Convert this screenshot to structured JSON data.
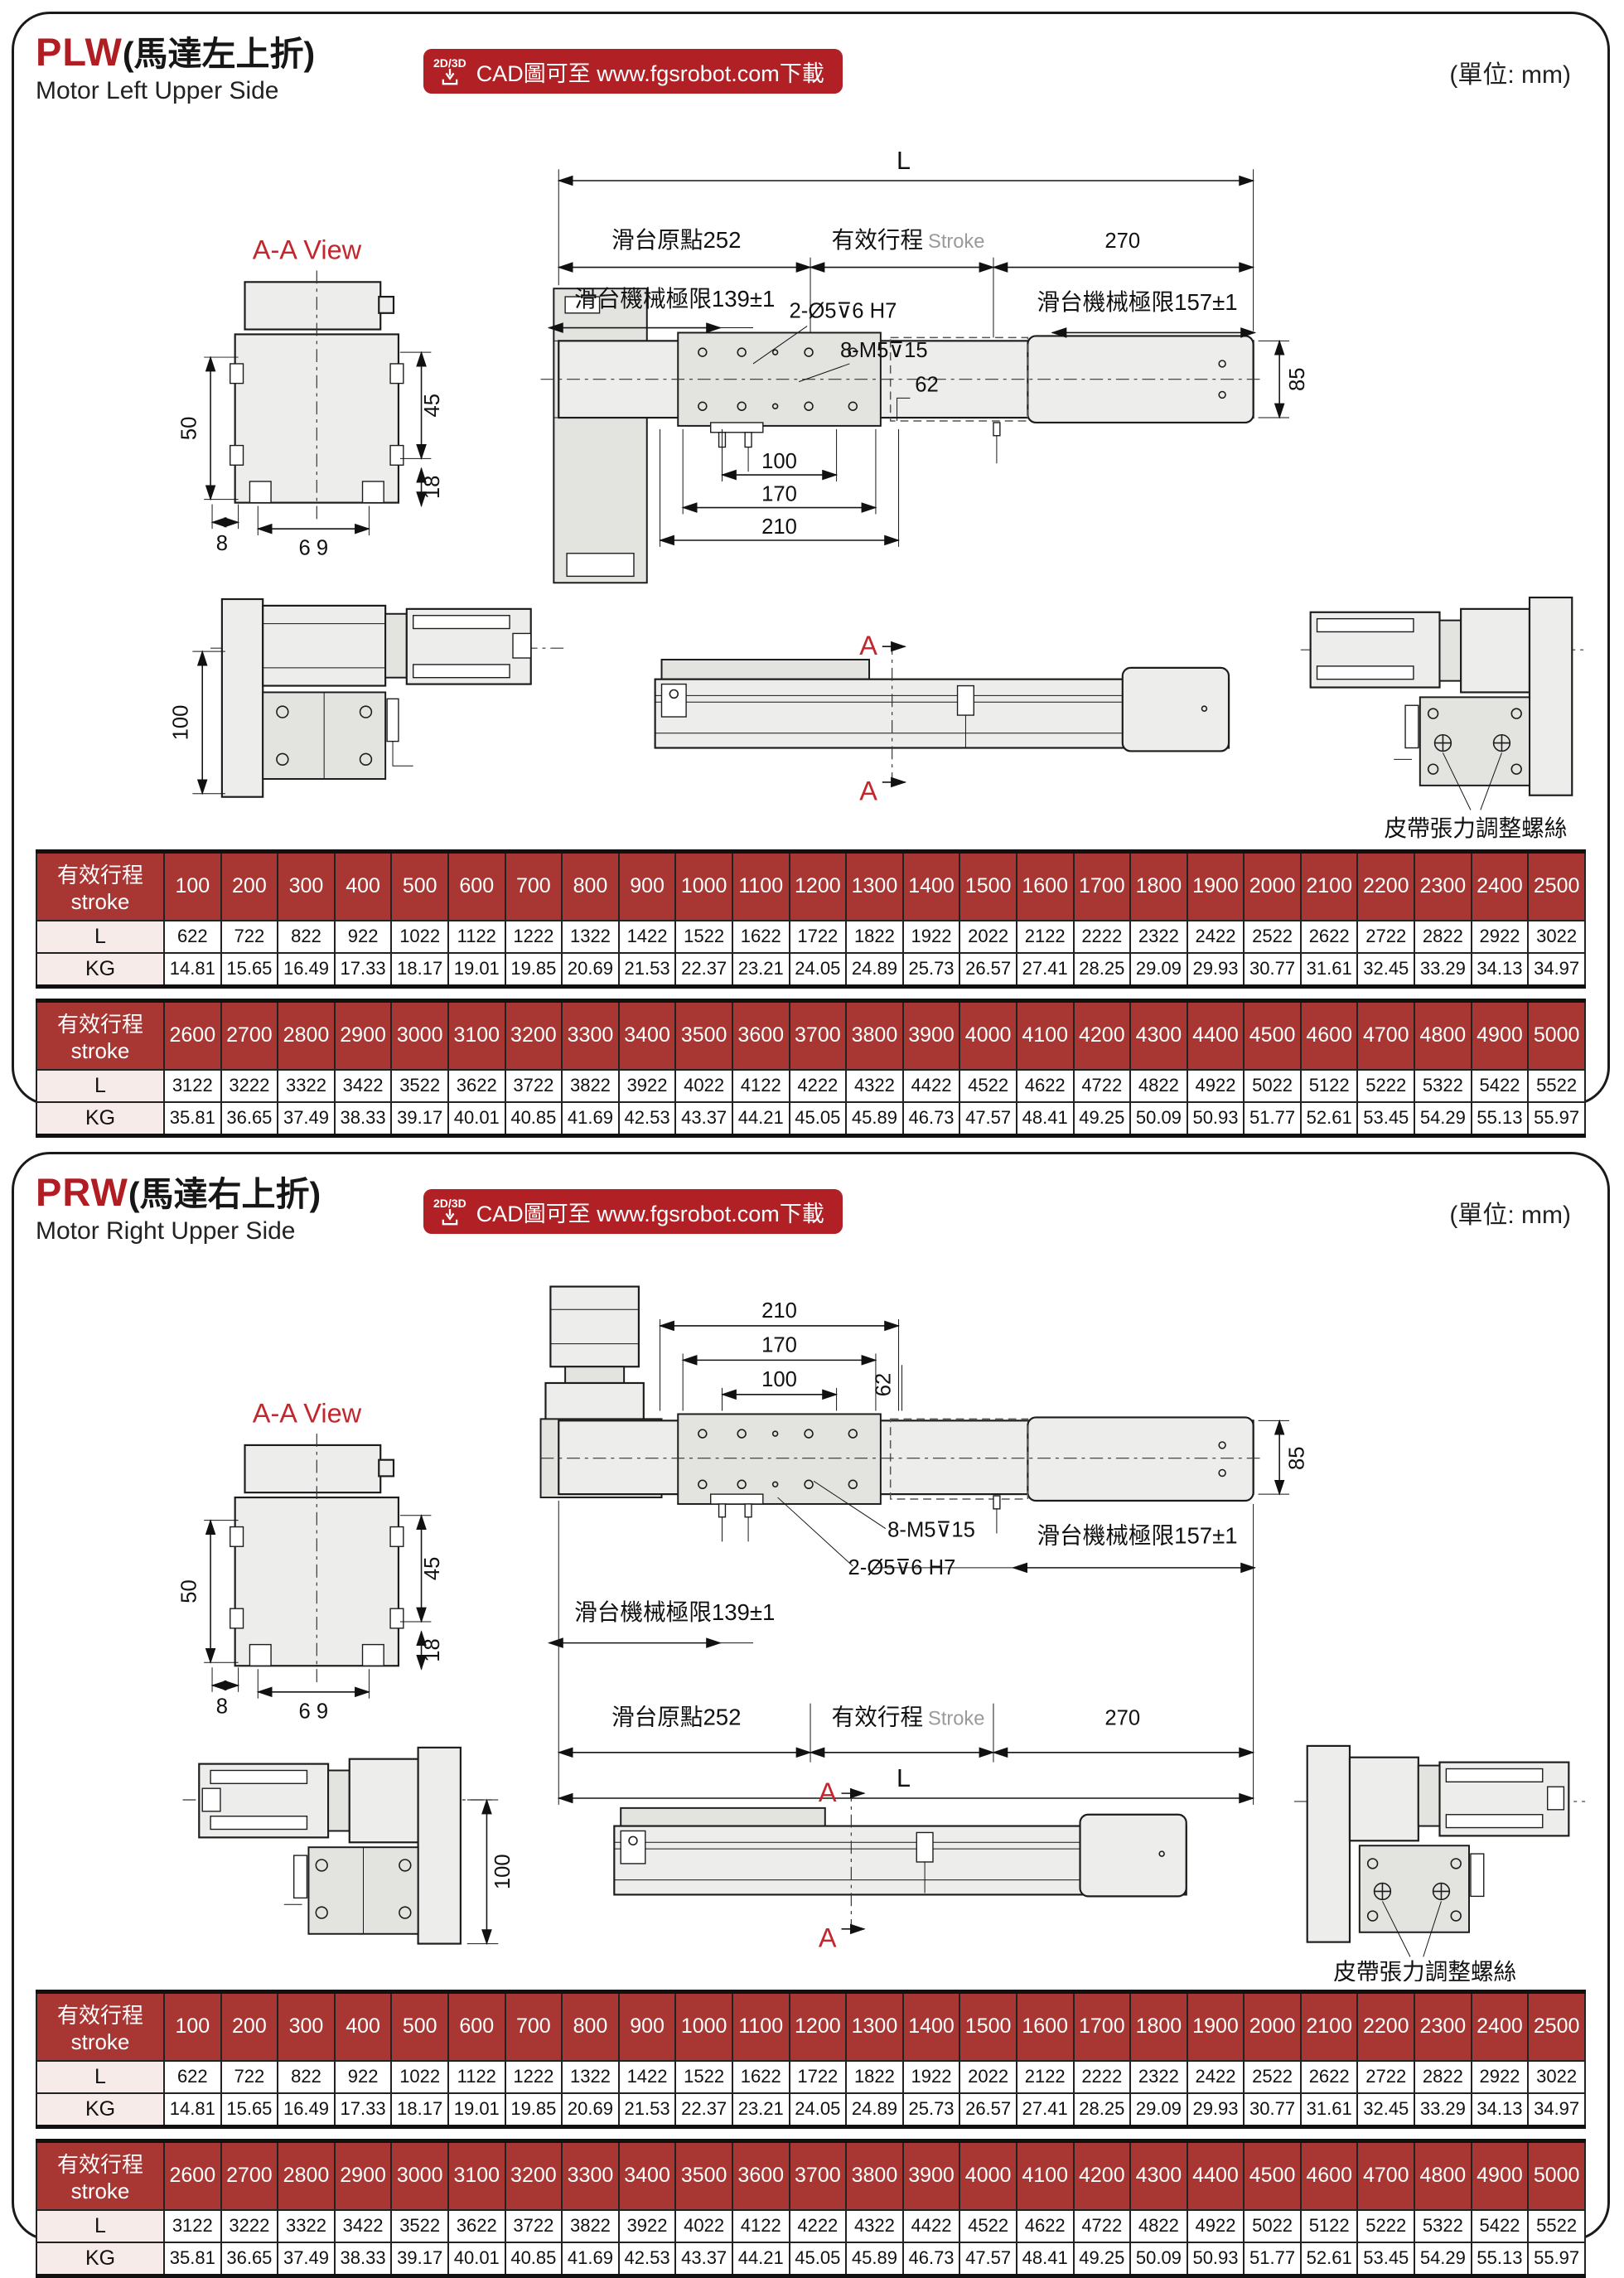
{
  "page": {
    "units_label": "(單位: mm)"
  },
  "badge": {
    "tag": "2D/3D",
    "text": "CAD圖可至 www.fgsrobot.com下載"
  },
  "sections": [
    {
      "code": "PLW",
      "title_zh": "(馬達左上折)",
      "title_en": "Motor Left Upper Side"
    },
    {
      "code": "PRW",
      "title_zh": "(馬達右上折)",
      "title_en": "Motor Right Upper Side"
    }
  ],
  "labels": {
    "aa_view": "A-A View",
    "L": "L",
    "origin": "滑台原點252",
    "stroke_zh": "有效行程",
    "stroke_en": "Stroke",
    "d270": "270",
    "limit139": "滑台機械極限139±1",
    "limit157": "滑台機械極限157±1",
    "holes_pin": "2-Ø5⊽6 H7",
    "holes_tap": "8-M5⊽15",
    "d62": "62",
    "d85": "85",
    "d100": "100",
    "d170": "170",
    "d210": "210",
    "d50": "50",
    "d45": "45",
    "d8": "8",
    "d69": "6 9",
    "d18": "18",
    "section_a": "A",
    "belt": "皮帶張力調整螺絲"
  },
  "table": {
    "header_zh": "有效行程",
    "header_en": "stroke",
    "row_L": "L",
    "row_KG": "KG",
    "t1": {
      "strokes": [
        "100",
        "200",
        "300",
        "400",
        "500",
        "600",
        "700",
        "800",
        "900",
        "1000",
        "1100",
        "1200",
        "1300",
        "1400",
        "1500",
        "1600",
        "1700",
        "1800",
        "1900",
        "2000",
        "2100",
        "2200",
        "2300",
        "2400",
        "2500"
      ],
      "L": [
        "622",
        "722",
        "822",
        "922",
        "1022",
        "1122",
        "1222",
        "1322",
        "1422",
        "1522",
        "1622",
        "1722",
        "1822",
        "1922",
        "2022",
        "2122",
        "2222",
        "2322",
        "2422",
        "2522",
        "2622",
        "2722",
        "2822",
        "2922",
        "3022"
      ],
      "KG": [
        "14.81",
        "15.65",
        "16.49",
        "17.33",
        "18.17",
        "19.01",
        "19.85",
        "20.69",
        "21.53",
        "22.37",
        "23.21",
        "24.05",
        "24.89",
        "25.73",
        "26.57",
        "27.41",
        "28.25",
        "29.09",
        "29.93",
        "30.77",
        "31.61",
        "32.45",
        "33.29",
        "34.13",
        "34.97"
      ]
    },
    "t2": {
      "strokes": [
        "2600",
        "2700",
        "2800",
        "2900",
        "3000",
        "3100",
        "3200",
        "3300",
        "3400",
        "3500",
        "3600",
        "3700",
        "3800",
        "3900",
        "4000",
        "4100",
        "4200",
        "4300",
        "4400",
        "4500",
        "4600",
        "4700",
        "4800",
        "4900",
        "5000"
      ],
      "L": [
        "3122",
        "3222",
        "3322",
        "3422",
        "3522",
        "3622",
        "3722",
        "3822",
        "3922",
        "4022",
        "4122",
        "4222",
        "4322",
        "4422",
        "4522",
        "4622",
        "4722",
        "4822",
        "4922",
        "5022",
        "5122",
        "5222",
        "5322",
        "5422",
        "5522"
      ],
      "KG": [
        "35.81",
        "36.65",
        "37.49",
        "38.33",
        "39.17",
        "40.01",
        "40.85",
        "41.69",
        "42.53",
        "43.37",
        "44.21",
        "45.05",
        "45.89",
        "46.73",
        "47.57",
        "48.41",
        "49.25",
        "50.09",
        "50.93",
        "51.77",
        "52.61",
        "53.45",
        "54.29",
        "55.13",
        "55.97"
      ]
    }
  }
}
